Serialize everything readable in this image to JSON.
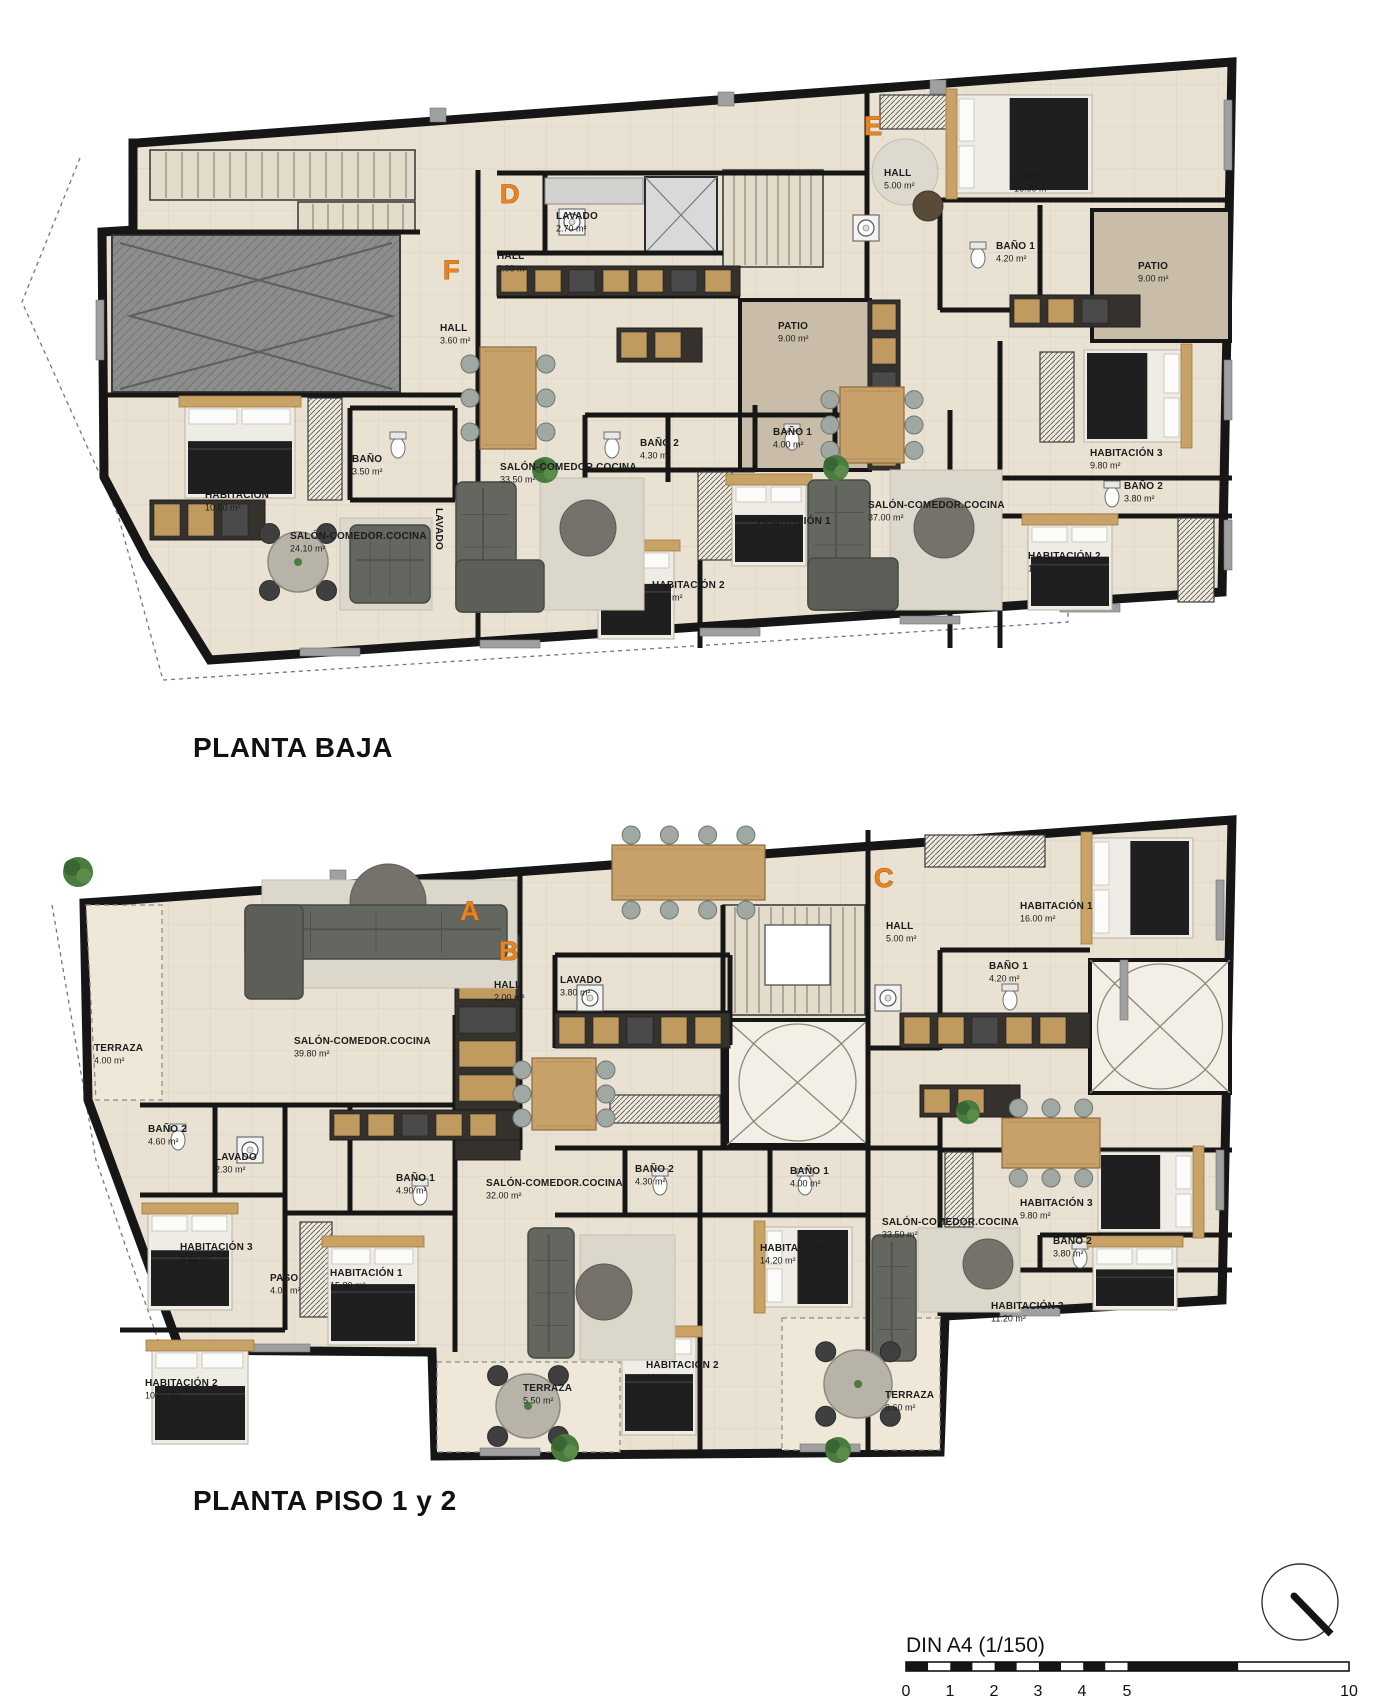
{
  "sheet": {
    "background": "#ffffff",
    "scale_text": "DIN A4 (1/150)"
  },
  "plans": [
    {
      "id": "planta-baja",
      "title": "PLANTA BAJA",
      "title_pos": {
        "x": 193,
        "y": 757
      },
      "apartments": [
        {
          "letter": "F",
          "letter_pos": {
            "x": 443,
            "y": 279
          },
          "rooms": [
            {
              "name": "HALL",
              "area": "3.60 m²",
              "x": 440,
              "y": 331
            },
            {
              "name": "BAÑO",
              "area": "3.50 m²",
              "x": 352,
              "y": 462
            },
            {
              "name": "HABITACIÓN",
              "area": "10.60 m²",
              "x": 205,
              "y": 498
            },
            {
              "name": "SALÓN-COMEDOR.COCINA",
              "area": "24.10 m²",
              "x": 290,
              "y": 539
            },
            {
              "name": "LAVADO",
              "area": "",
              "x": 436,
              "y": 508,
              "rotate": 90
            }
          ]
        },
        {
          "letter": "D",
          "letter_pos": {
            "x": 500,
            "y": 203
          },
          "rooms": [
            {
              "name": "LAVADO",
              "area": "2.70 m²",
              "x": 556,
              "y": 219
            },
            {
              "name": "HALL",
              "area": "2.00 m²",
              "x": 497,
              "y": 259
            },
            {
              "name": "SALÓN-COMEDOR.COCINA",
              "area": "33.50 m²",
              "x": 500,
              "y": 470
            },
            {
              "name": "BAÑO 2",
              "area": "4.30 m²",
              "x": 640,
              "y": 446
            },
            {
              "name": "BAÑO 1",
              "area": "4.00 m²",
              "x": 773,
              "y": 435
            },
            {
              "name": "HABITACIÓN 1",
              "area": "12.00 m²",
              "x": 758,
              "y": 524
            },
            {
              "name": "HABITACIÓN 2",
              "area": "8.30 m²",
              "x": 652,
              "y": 588
            },
            {
              "name": "PATIO",
              "area": "9.00 m²",
              "x": 778,
              "y": 329
            }
          ]
        },
        {
          "letter": "E",
          "letter_pos": {
            "x": 864,
            "y": 135
          },
          "rooms": [
            {
              "name": "HALL",
              "area": "5.00 m²",
              "x": 884,
              "y": 176
            },
            {
              "name": "HABITACIÓN 1",
              "area": "16.00 m²",
              "x": 1014,
              "y": 179
            },
            {
              "name": "BAÑO 1",
              "area": "4.20 m²",
              "x": 996,
              "y": 249
            },
            {
              "name": "PATIO",
              "area": "9.00 m²",
              "x": 1138,
              "y": 269
            },
            {
              "name": "SALÓN-COMEDOR.COCINA",
              "area": "37.00 m²",
              "x": 868,
              "y": 508
            },
            {
              "name": "HABITACIÓN 3",
              "area": "9.80 m²",
              "x": 1090,
              "y": 456
            },
            {
              "name": "BAÑO 2",
              "area": "3.80 m²",
              "x": 1124,
              "y": 489
            },
            {
              "name": "HABITACIÓN 2",
              "area": "10.00 m²",
              "x": 1028,
              "y": 559
            }
          ]
        }
      ]
    },
    {
      "id": "planta-piso-1-2",
      "title": "PLANTA PISO 1 y 2",
      "title_pos": {
        "x": 193,
        "y": 1510
      },
      "apartments": [
        {
          "letter": "A",
          "letter_pos": {
            "x": 460,
            "y": 920
          },
          "rooms": [
            {
              "name": "TERRAZA",
              "area": "4.00 m²",
              "x": 94,
              "y": 1051
            },
            {
              "name": "SALÓN-COMEDOR.COCINA",
              "area": "39.80 m²",
              "x": 294,
              "y": 1044
            },
            {
              "name": "BAÑO 2",
              "area": "4.60 m²",
              "x": 148,
              "y": 1132
            },
            {
              "name": "LAVADO",
              "area": "2.30 m²",
              "x": 215,
              "y": 1160
            },
            {
              "name": "HABITACIÓN 3",
              "area": "9.40 m²",
              "x": 180,
              "y": 1250
            },
            {
              "name": "PASO",
              "area": "4.00 m²",
              "x": 270,
              "y": 1281
            },
            {
              "name": "BAÑO 1",
              "area": "4.90 m²",
              "x": 396,
              "y": 1181
            },
            {
              "name": "HABITACIÓN 1",
              "area": "15.80 m²",
              "x": 330,
              "y": 1276
            },
            {
              "name": "HABITACIÓN 2",
              "area": "10.00 m²",
              "x": 145,
              "y": 1386
            }
          ]
        },
        {
          "letter": "B",
          "letter_pos": {
            "x": 499,
            "y": 960
          },
          "rooms": [
            {
              "name": "HALL",
              "area": "2.00 m²",
              "x": 494,
              "y": 988
            },
            {
              "name": "LAVADO",
              "area": "3.80 m²",
              "x": 560,
              "y": 983
            },
            {
              "name": "SALÓN-COMEDOR.COCINA",
              "area": "32.00 m²",
              "x": 486,
              "y": 1186
            },
            {
              "name": "BAÑO 2",
              "area": "4.30 m²",
              "x": 635,
              "y": 1172
            },
            {
              "name": "BAÑO 1",
              "area": "4.00 m²",
              "x": 790,
              "y": 1174
            },
            {
              "name": "HABITACIÓN 1",
              "area": "14.20 m²",
              "x": 760,
              "y": 1251
            },
            {
              "name": "HABITACIÓN 2",
              "area": "10.60 m²",
              "x": 646,
              "y": 1368
            },
            {
              "name": "TERRAZA",
              "area": "5.50 m²",
              "x": 523,
              "y": 1391
            }
          ]
        },
        {
          "letter": "C",
          "letter_pos": {
            "x": 874,
            "y": 887
          },
          "rooms": [
            {
              "name": "HALL",
              "area": "5.00 m²",
              "x": 886,
              "y": 929
            },
            {
              "name": "HABITACIÓN 1",
              "area": "16.00 m²",
              "x": 1020,
              "y": 909
            },
            {
              "name": "BAÑO 1",
              "area": "4.20 m²",
              "x": 989,
              "y": 969
            },
            {
              "name": "SALÓN-COMEDOR.COCINA",
              "area": "33.50 m²",
              "x": 882,
              "y": 1225
            },
            {
              "name": "HABITACIÓN 3",
              "area": "9.80 m²",
              "x": 1020,
              "y": 1206
            },
            {
              "name": "BAÑO 2",
              "area": "3.80 m²",
              "x": 1053,
              "y": 1244
            },
            {
              "name": "HABITACIÓN 2",
              "area": "11.20 m²",
              "x": 991,
              "y": 1309
            },
            {
              "name": "TERRAZA",
              "area": "6.60 m²",
              "x": 885,
              "y": 1398
            }
          ]
        }
      ]
    }
  ],
  "scale_bar": {
    "label": "DIN A4 (1/150)",
    "label_pos": {
      "x": 906,
      "y": 1652
    },
    "bar": {
      "x": 906,
      "y": 1662,
      "width": 443,
      "height": 9
    },
    "ticks": [
      {
        "t": "0",
        "x": 906
      },
      {
        "t": "1",
        "x": 950
      },
      {
        "t": "2",
        "x": 994
      },
      {
        "t": "3",
        "x": 1038
      },
      {
        "t": "4",
        "x": 1082
      },
      {
        "t": "5",
        "x": 1127
      },
      {
        "t": "10",
        "x": 1349
      }
    ],
    "tick_y": 1696
  },
  "icons": {
    "north_indicator": "compass-circle-with-needle"
  },
  "colors": {
    "floor": "#e9e1d2",
    "floor_light": "#efe8d8",
    "wall": "#161616",
    "patio": "#c9bda9",
    "ramp": "#8d8d8d",
    "accent_letter": "#e8831f",
    "wood": "#c8a06a",
    "sofa": "#63675f",
    "label_text": "#1c1c1c"
  }
}
